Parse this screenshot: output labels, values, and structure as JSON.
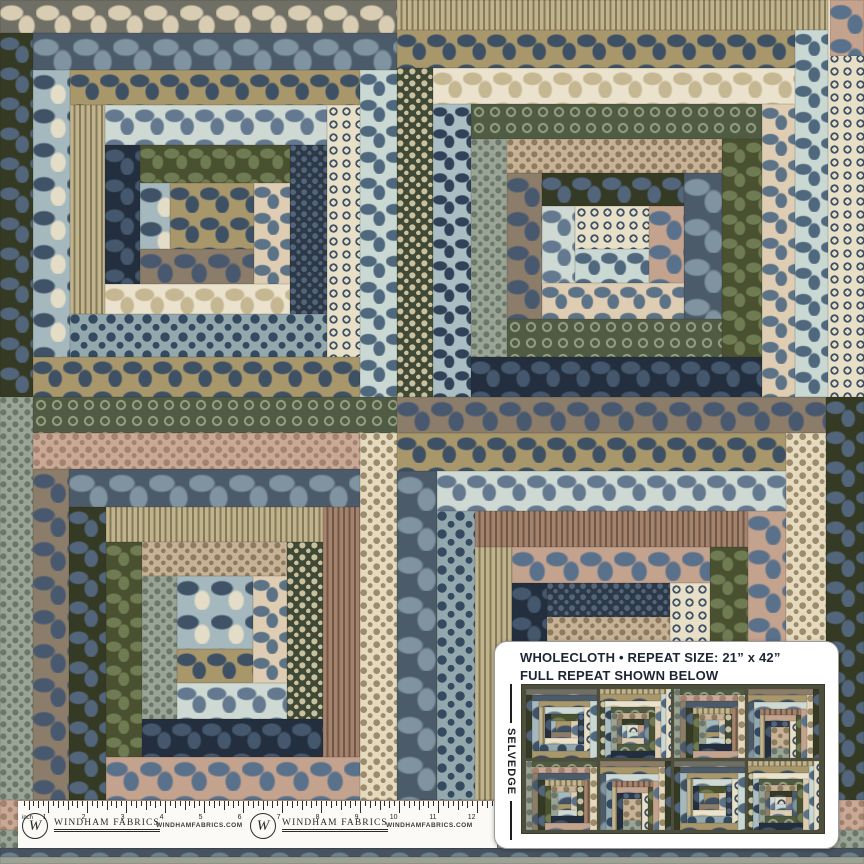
{
  "info_card": {
    "line1": "WHOLECLOTH • REPEAT SIZE: 21” x 42”",
    "line2": "FULL REPEAT SHOWN BELOW",
    "selvedge_label": "SELVEDGE"
  },
  "ruler": {
    "unit_label": "inch",
    "numbers": [
      "1",
      "2",
      "3",
      "4",
      "5",
      "6",
      "7",
      "8",
      "9",
      "10",
      "11",
      "12"
    ],
    "brand_monogram": "W",
    "brand_name": "WINDHAM FABRICS",
    "brand_url": "WINDHAMFABRICS.COM"
  },
  "colors": {
    "card_bg": "#ffffff",
    "card_border": "#9c9c9c",
    "ink": "#1d2533",
    "ruler_bg": "#fbfaf6",
    "thumbnail_bg": "#4e4e3c"
  },
  "palette": {
    "fabrics": [
      {
        "id": "charcoal",
        "type": "blob",
        "bg": "#6f6f65",
        "fg": "#d8ccb2",
        "size": 36
      },
      {
        "id": "slateflo",
        "type": "blob",
        "bg": "#4c5b69",
        "fg": "#7f93a1",
        "size": 40
      },
      {
        "id": "khaki",
        "type": "blob",
        "bg": "#a9976c",
        "fg": "#3d5064",
        "size": 30
      },
      {
        "id": "oliveflo",
        "type": "blob",
        "bg": "#343a23",
        "fg": "#52657b",
        "size": 30
      },
      {
        "id": "bluepais",
        "type": "blob",
        "bg": "#a4b8be",
        "fg": "#3f5266",
        "fg2": "#e3dcc6",
        "size": 34
      },
      {
        "id": "beigestripe",
        "type": "stripe",
        "bg": "#c2b38f",
        "fg": "#847b57",
        "size": 6
      },
      {
        "id": "creamsprig",
        "type": "ring",
        "bg": "#e8dfc7",
        "fg": "#41536a",
        "size": 13
      },
      {
        "id": "ltblueleaf",
        "type": "blob",
        "bg": "#c9d8d2",
        "fg": "#4f687d",
        "size": 26
      },
      {
        "id": "navydot",
        "type": "dot",
        "bg": "#2d3947",
        "fg": "#52657b",
        "size": 11
      },
      {
        "id": "aquaflo",
        "type": "blob",
        "bg": "#cdd9d2",
        "fg": "#64798f",
        "size": 30
      },
      {
        "id": "creamflo",
        "type": "blob",
        "bg": "#eae2cc",
        "fg": "#c6b793",
        "size": 30
      },
      {
        "id": "tandot",
        "type": "dot",
        "bg": "#c8b296",
        "fg": "#8d7b5f",
        "size": 12
      },
      {
        "id": "pinkflo",
        "type": "blob",
        "bg": "#c3a28e",
        "fg": "#5a718b",
        "size": 34
      },
      {
        "id": "sagedot",
        "type": "dot",
        "bg": "#9aa495",
        "fg": "#6c776b",
        "size": 12
      },
      {
        "id": "oliveleaf",
        "type": "blob",
        "bg": "#4a5130",
        "fg": "#6f7b53",
        "size": 24
      },
      {
        "id": "bluedotbig",
        "type": "dot",
        "bg": "#93a8ad",
        "fg": "#344a60",
        "size": 18
      },
      {
        "id": "brownflo",
        "type": "blob",
        "bg": "#8c7c6a",
        "fg": "#48596f",
        "size": 34
      },
      {
        "id": "navyleaf",
        "type": "blob",
        "bg": "#232f3e",
        "fg": "#45576c",
        "size": 30
      },
      {
        "id": "greenvine",
        "type": "ring",
        "bg": "#505b43",
        "fg": "#909b7d",
        "size": 16
      },
      {
        "id": "taupestripe",
        "type": "stripe",
        "bg": "#a5826b",
        "fg": "#6f5847",
        "size": 5
      },
      {
        "id": "creamdot",
        "type": "dot",
        "bg": "#e5dabe",
        "fg": "#9c8b6d",
        "size": 13
      },
      {
        "id": "olivesprig",
        "type": "dot",
        "bg": "#3f4935",
        "fg": "#c8c09f",
        "size": 12
      },
      {
        "id": "creampais",
        "type": "blob",
        "bg": "#decdb2",
        "fg": "#5c7287",
        "size": 26
      },
      {
        "id": "bluecoral",
        "type": "blob",
        "bg": "#aabdc3",
        "fg": "#2f4257",
        "size": 22
      },
      {
        "id": "pinkdot",
        "type": "dot",
        "bg": "#caa896",
        "fg": "#a3836f",
        "size": 13
      },
      {
        "id": "slatedam",
        "type": "blob",
        "bg": "#47535f",
        "fg": "#6c808e",
        "size": 30
      },
      {
        "id": "grayplain",
        "type": "plain",
        "bg": "#9da295",
        "fg": "#9da295",
        "size": 10
      }
    ]
  },
  "fabric_blocks": [
    {
      "id": "TL",
      "x": 0,
      "y": 0,
      "w": 397,
      "h": 397,
      "logs": [
        [
          "T",
          33,
          "charcoal"
        ],
        [
          "L",
          33,
          "oliveflo"
        ],
        [
          "T",
          37,
          "slateflo"
        ],
        [
          "R",
          37,
          "ltblueleaf"
        ],
        [
          "B",
          40,
          "khaki"
        ],
        [
          "L",
          37,
          "bluepais"
        ],
        [
          "T",
          35,
          "khaki"
        ],
        [
          "R",
          33,
          "creamsprig"
        ],
        [
          "B",
          43,
          "bluedotbig"
        ],
        [
          "L",
          35,
          "beigestripe"
        ],
        [
          "T",
          40,
          "aquaflo"
        ],
        [
          "R",
          37,
          "navydot"
        ],
        [
          "B",
          30,
          "creamflo"
        ],
        [
          "L",
          35,
          "navyleaf"
        ],
        [
          "T",
          38,
          "oliveleaf"
        ],
        [
          "R",
          36,
          "creampais"
        ],
        [
          "B",
          35,
          "brownflo"
        ],
        [
          "L",
          30,
          "bluepais"
        ],
        [
          "C",
          0,
          "khaki"
        ]
      ]
    },
    {
      "id": "TR",
      "x": 397,
      "y": 0,
      "w": 467,
      "h": 397,
      "logs": [
        [
          "R",
          36,
          "creamsprig"
        ],
        [
          "T",
          30,
          "beigestripe"
        ],
        [
          "R",
          33,
          "ltblueleaf"
        ],
        [
          "T",
          38,
          "khaki"
        ],
        [
          "L",
          36,
          "olivesprig"
        ],
        [
          "T",
          36,
          "creamflo"
        ],
        [
          "R",
          33,
          "creampais"
        ],
        [
          "L",
          38,
          "bluecoral"
        ],
        [
          "B",
          40,
          "navyleaf"
        ],
        [
          "T",
          35,
          "greenvine"
        ],
        [
          "L",
          36,
          "sagedot"
        ],
        [
          "R",
          40,
          "oliveleaf"
        ],
        [
          "B",
          38,
          "greenvine"
        ],
        [
          "T",
          34,
          "tandot"
        ],
        [
          "L",
          35,
          "brownflo"
        ],
        [
          "R",
          38,
          "slateflo"
        ],
        [
          "B",
          36,
          "creampais"
        ],
        [
          "T",
          33,
          "oliveflo"
        ],
        [
          "L",
          33,
          "aquaflo"
        ],
        [
          "R",
          35,
          "pinkflo"
        ],
        [
          "B",
          34,
          "ltblueleaf"
        ],
        [
          "C",
          0,
          "creamsprig"
        ]
      ]
    },
    {
      "id": "BL",
      "x": 0,
      "y": 397,
      "w": 397,
      "h": 403,
      "logs": [
        [
          "L",
          33,
          "sagedot"
        ],
        [
          "T",
          36,
          "greenvine"
        ],
        [
          "R",
          37,
          "creamdot"
        ],
        [
          "T",
          36,
          "pinkdot"
        ],
        [
          "L",
          36,
          "brownflo"
        ],
        [
          "T",
          38,
          "slateflo"
        ],
        [
          "L",
          37,
          "oliveflo"
        ],
        [
          "B",
          43,
          "pinkflo"
        ],
        [
          "R",
          37,
          "taupestripe"
        ],
        [
          "T",
          35,
          "beigestripe"
        ],
        [
          "L",
          36,
          "oliveleaf"
        ],
        [
          "B",
          38,
          "navyleaf"
        ],
        [
          "R",
          36,
          "olivesprig"
        ],
        [
          "T",
          34,
          "tandot"
        ],
        [
          "L",
          35,
          "sagedot"
        ],
        [
          "B",
          36,
          "aquaflo"
        ],
        [
          "R",
          34,
          "creampais"
        ],
        [
          "B",
          34,
          "khaki"
        ],
        [
          "C",
          0,
          "bluepais"
        ]
      ]
    },
    {
      "id": "BR",
      "x": 397,
      "y": 397,
      "w": 467,
      "h": 403,
      "logs": [
        [
          "R",
          38,
          "oliveflo"
        ],
        [
          "T",
          36,
          "brownflo"
        ],
        [
          "R",
          40,
          "creamdot"
        ],
        [
          "T",
          38,
          "khaki"
        ],
        [
          "L",
          40,
          "slateflo"
        ],
        [
          "T",
          40,
          "aquaflo"
        ],
        [
          "L",
          38,
          "bluedotbig"
        ],
        [
          "R",
          38,
          "pinkflo"
        ],
        [
          "T",
          36,
          "taupestripe"
        ],
        [
          "L",
          37,
          "beigestripe"
        ],
        [
          "R",
          38,
          "oliveleaf"
        ],
        [
          "T",
          36,
          "pinkflo"
        ],
        [
          "L",
          35,
          "navyleaf"
        ],
        [
          "R",
          40,
          "creamsprig"
        ],
        [
          "B",
          60,
          "sagedot"
        ],
        [
          "T",
          34,
          "navydot"
        ],
        [
          "C",
          0,
          "tandot"
        ]
      ]
    }
  ],
  "edge_strips": [
    {
      "x": 830,
      "y": 0,
      "w": 34,
      "h": 56,
      "fabric": "pinkflo"
    },
    {
      "x": 0,
      "y": 800,
      "w": 864,
      "h": 30,
      "fabric": "pinkdot"
    },
    {
      "x": 0,
      "y": 830,
      "w": 864,
      "h": 18,
      "fabric": "sagedot"
    },
    {
      "x": 0,
      "y": 848,
      "w": 864,
      "h": 9,
      "fabric": "slatedam"
    },
    {
      "x": 0,
      "y": 857,
      "w": 864,
      "h": 7,
      "fabric": "grayplain"
    }
  ],
  "repeat_thumbnail": {
    "block_order": [
      "TL",
      "TR",
      "BL",
      "BR",
      "BL",
      "BR",
      "TL",
      "TR"
    ]
  }
}
